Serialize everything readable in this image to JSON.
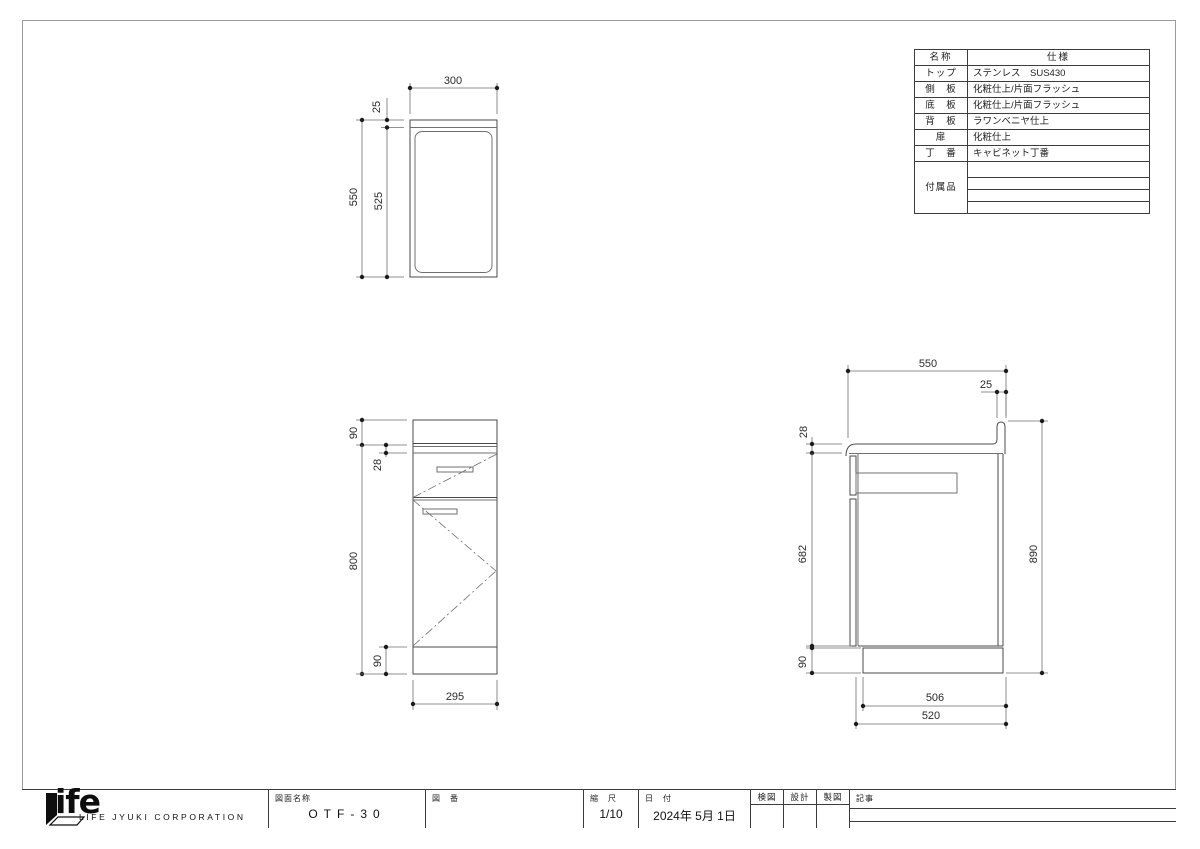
{
  "spec_table": {
    "header": {
      "name": "名称",
      "spec": "仕様"
    },
    "rows": [
      {
        "name": "トップ",
        "spec": "ステンレス　SUS430"
      },
      {
        "name": "側　板",
        "spec": "化粧仕上/片面フラッシュ"
      },
      {
        "name": "底　板",
        "spec": "化粧仕上/片面フラッシュ"
      },
      {
        "name": "背　板",
        "spec": "ラワンベニヤ仕上"
      },
      {
        "name": "扉",
        "spec": "化粧仕上"
      },
      {
        "name": "丁　番",
        "spec": "キャビネット丁番"
      }
    ],
    "accessories_label": "付属品"
  },
  "dims": {
    "plan_width": "300",
    "plan_backsplash": "25",
    "plan_depth": "550",
    "plan_inner": "525",
    "front_top": "90",
    "front_edge": "28",
    "front_body": "800",
    "front_kick": "90",
    "front_width": "295",
    "side_depth": "550",
    "side_backsplash": "25",
    "side_counter": "28",
    "side_body": "682",
    "side_kick": "90",
    "side_height": "890",
    "side_kick_depth": "506",
    "side_body_depth": "520"
  },
  "title_block": {
    "logo_text": "ife",
    "company": "LIFE JYUKI CORPORATION",
    "drawing_name_label": "図面名称",
    "drawing_name": "OTF-30",
    "drawing_no_label": "図　番",
    "scale_label": "縮　尺",
    "scale": "1/10",
    "date_label": "日　付",
    "date": "2024年 5月 1日",
    "check_label": "検図",
    "design_label": "設計",
    "draft_label": "製図",
    "remarks_label": "記事"
  }
}
